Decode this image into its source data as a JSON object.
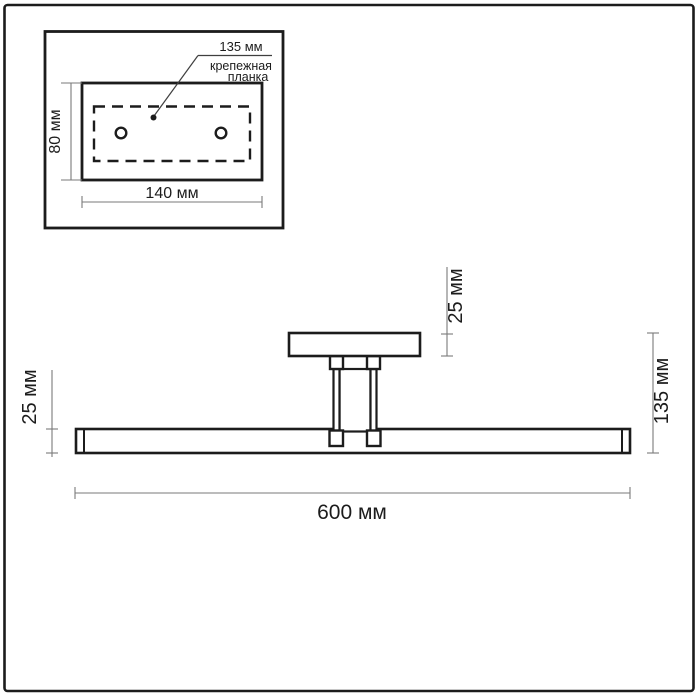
{
  "colors": {
    "background": "#ffffff",
    "outline": "#1c1c1c",
    "dimension_line": "#7a7a7a",
    "leader_line": "#3f3f3f"
  },
  "inset": {
    "labels": {
      "hole_pitch": "135 мм",
      "bracket_caption_line1": "крепежная",
      "bracket_caption_line2": "планка",
      "plate_height": "80 мм",
      "plate_width": "140 мм"
    }
  },
  "main": {
    "labels": {
      "bar_height": "25 мм",
      "canopy_height": "25 мм",
      "overall_height": "135 мм",
      "overall_length": "600 мм"
    }
  }
}
